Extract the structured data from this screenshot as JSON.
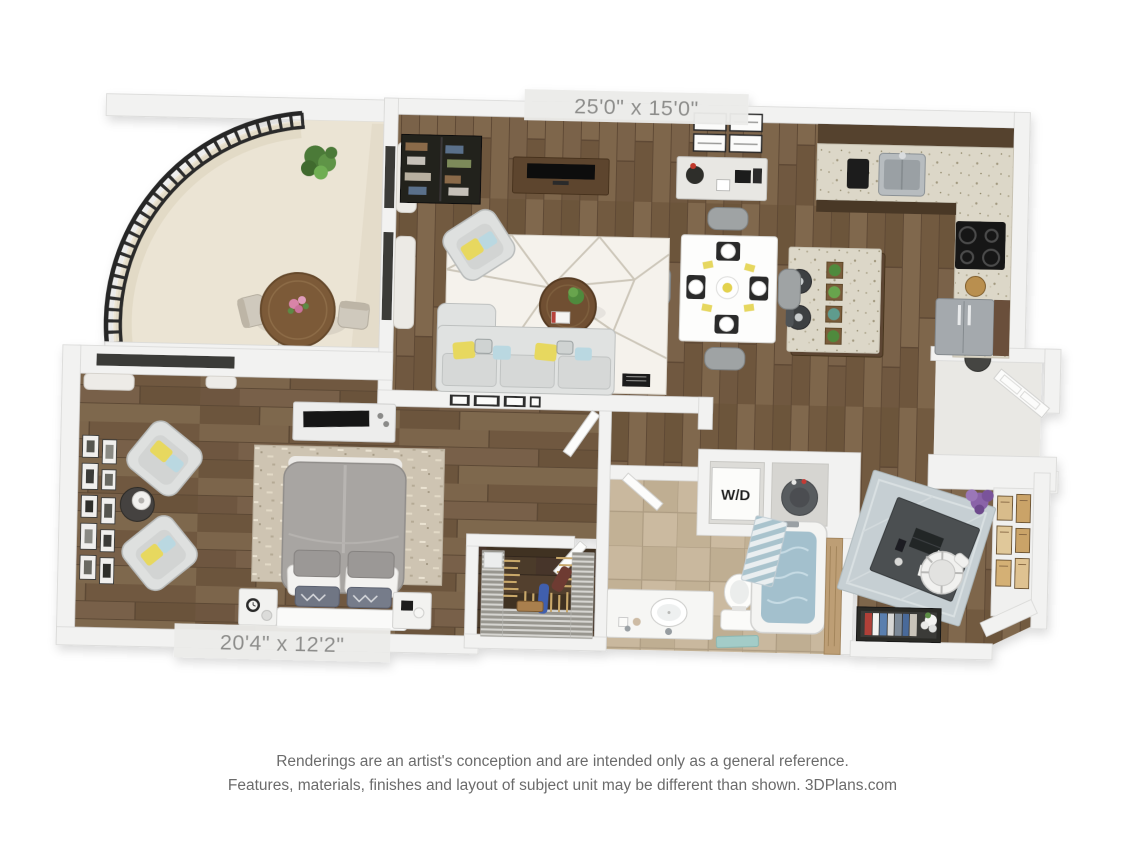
{
  "plan": {
    "living_dim_label": "25'0\" x 15'0\"",
    "bedroom_dim_label": "20'4\" x 12'2\"",
    "wd_label": "W/D",
    "colors": {
      "background": "#ffffff",
      "wall": "#f2f2f1",
      "wood_floor": "#79614a",
      "wood_floor_dark": "#463629",
      "tile_floor": "#c6b59b",
      "balcony_floor": "#ebe4d4",
      "backsplash": "#8c7164",
      "countertop": "#dcd7c8",
      "railing": "#2b2b2b",
      "living_rug": "#f5f2ec",
      "bedroom_rug": "#cec4b2",
      "office_rug": "#c6cfd3",
      "sofa": "#e0e2e1",
      "accent_pillow_yellow": "#e7d85f",
      "accent_pillow_blue": "#bad8e1",
      "tub_water": "#a3c0cd",
      "plant_green": "#5e8f47",
      "label_text": "#8d8d8b",
      "disclaimer_text": "#6b6b6b"
    }
  },
  "footer": {
    "line1": "Renderings are an artist's conception and are intended only as a general reference.",
    "line2": "Features, materials, finishes and layout of subject unit may be different than shown. 3DPlans.com"
  }
}
